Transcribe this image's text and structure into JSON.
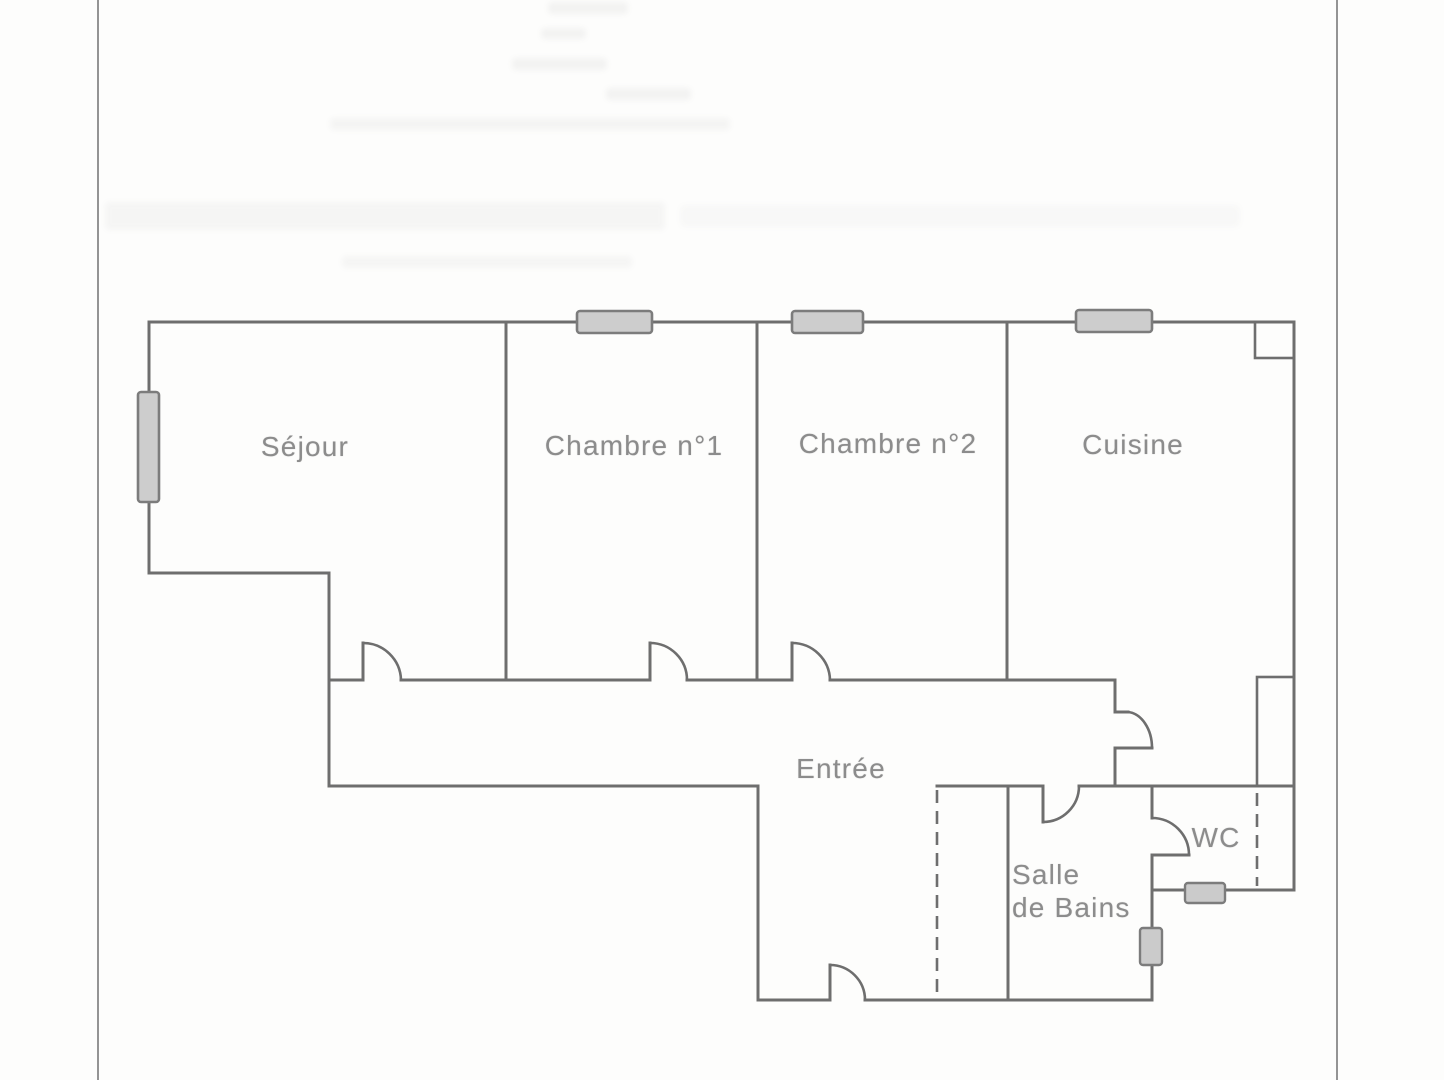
{
  "document": {
    "kind": "scanned apartment floor plan",
    "language": "fr"
  },
  "colors": {
    "wall": "#6e6e6e",
    "label_text": "#8c8c8c",
    "window_fill": "#cdcdcd",
    "window_border": "#7c7c7c",
    "fixture_fill": "#cbcbcb",
    "scan_border": "#949494",
    "hatch": "#858585",
    "paper": "#fdfdfc"
  },
  "floor_plan": {
    "rooms": [
      {
        "key": "sejour",
        "label": "Séjour"
      },
      {
        "key": "chambre1",
        "label": "Chambre n°1"
      },
      {
        "key": "chambre2",
        "label": "Chambre n°2"
      },
      {
        "key": "cuisine",
        "label": "Cuisine"
      },
      {
        "key": "entree",
        "label": "Entrée"
      },
      {
        "key": "salle_de_bains",
        "label": "Salle de Bains",
        "label_lines": [
          "Salle",
          "de Bains"
        ]
      },
      {
        "key": "wc",
        "label": "WC"
      }
    ],
    "features": {
      "windows": [
        "sejour-left-wall",
        "chambre1-top-wall",
        "chambre2-top-wall",
        "cuisine-top-wall"
      ],
      "doors": [
        "sejour",
        "chambre1",
        "chambre2",
        "cuisine-entry",
        "salle-de-bains",
        "wc",
        "entree-main"
      ],
      "ducts": [
        "cuisine-top-right",
        "right-mid"
      ],
      "fixtures": [
        "wc-radiator",
        "salle-de-bains-radiator"
      ],
      "dashed_partitions": [
        "entree-closet",
        "wc-duct-side"
      ]
    }
  }
}
